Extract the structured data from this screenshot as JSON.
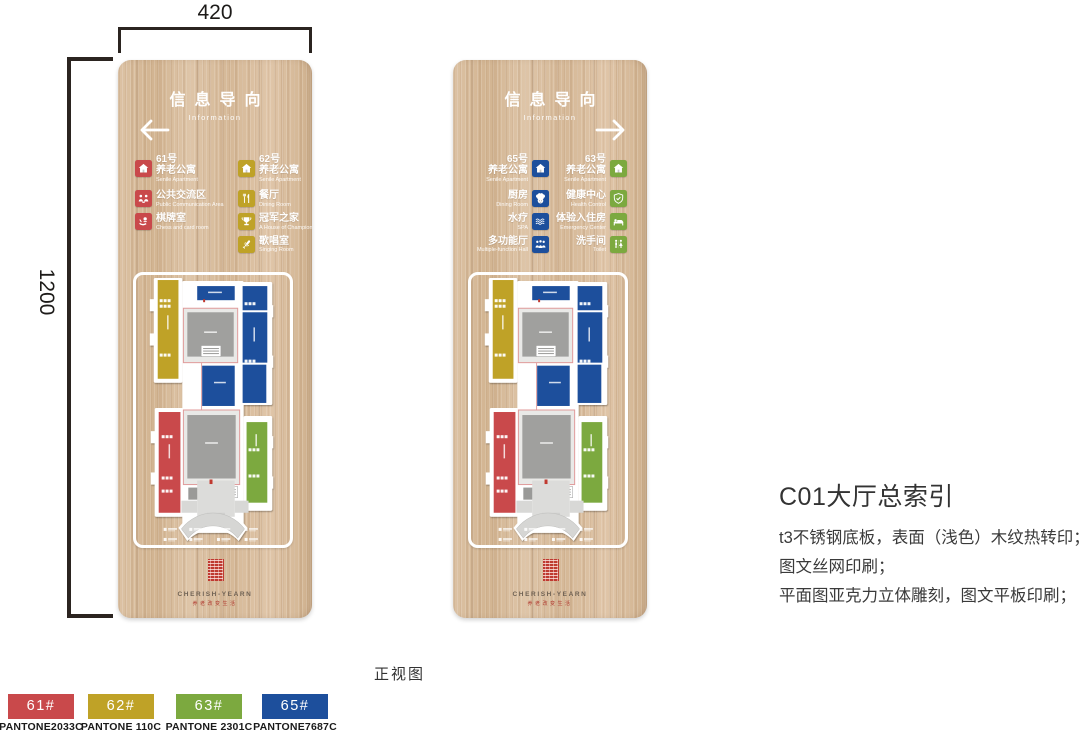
{
  "sheet": {
    "front_view_label": "正视图",
    "dim_width": "420",
    "dim_height": "1200"
  },
  "notes": {
    "title": "C01大厅总索引",
    "line1": "t3不锈钢底板，表面（浅色）木纹热转印；",
    "line2": "图文丝网印刷；",
    "line3": "平面图亚克力立体雕刻，图文平板印刷；"
  },
  "brand": {
    "name": "CHERISH-YEARN",
    "tagline": "养老改变生活"
  },
  "panels": {
    "left": {
      "header_title": "信息导向",
      "header_subtitle": "Information",
      "arrow": "left",
      "columns": [
        {
          "color": "#C9494B",
          "items": [
            {
              "icon": "house-icon",
              "no": "61号",
              "zh": "养老公寓",
              "en": "Senile Apartment"
            },
            {
              "icon": "people-icon",
              "zh": "公共交流区",
              "en": "Public Communication Area"
            },
            {
              "icon": "chess-icon",
              "zh": "棋牌室",
              "en": "Chess and card room"
            }
          ]
        },
        {
          "color": "#BFA227",
          "items": [
            {
              "icon": "house-icon",
              "no": "62号",
              "zh": "养老公寓",
              "en": "Senile Apartment"
            },
            {
              "icon": "dining-icon",
              "zh": "餐厅",
              "en": "Dining Room"
            },
            {
              "icon": "trophy-icon",
              "zh": "冠军之家",
              "en": "A House of Champions"
            },
            {
              "icon": "microphone-icon",
              "zh": "歌唱室",
              "en": "Singing Room"
            }
          ]
        }
      ]
    },
    "right": {
      "header_title": "信息导向",
      "header_subtitle": "Information",
      "arrow": "right",
      "columns": [
        {
          "color": "#1D4F9C",
          "items": [
            {
              "icon": "house-icon",
              "no": "65号",
              "zh": "养老公寓",
              "en": "Senile Apartment"
            },
            {
              "icon": "chef-icon",
              "zh": "厨房",
              "en": "Dining Room"
            },
            {
              "icon": "spa-icon",
              "zh": "水疗",
              "en": "SPA"
            },
            {
              "icon": "group-icon",
              "zh": "多功能厅",
              "en": "Multiple-function Hall"
            }
          ]
        },
        {
          "color": "#7CA93F",
          "items": [
            {
              "icon": "house-icon",
              "no": "63号",
              "zh": "养老公寓",
              "en": "Senile Apartment"
            },
            {
              "icon": "shield-icon",
              "zh": "健康中心",
              "en": "Health Control"
            },
            {
              "icon": "bed-icon",
              "zh": "体验入住房",
              "en": "Emergency Center"
            },
            {
              "icon": "toilet-icon",
              "zh": "洗手间",
              "en": "Toilet"
            }
          ]
        }
      ]
    }
  },
  "swatches": [
    {
      "label": "61#",
      "pantone": "PANTONE2033C",
      "color": "#C9494B"
    },
    {
      "label": "62#",
      "pantone": "PANTONE 110C",
      "color": "#BFA227"
    },
    {
      "label": "63#",
      "pantone": "PANTONE 2301C",
      "color": "#7CA93F"
    },
    {
      "label": "65#",
      "pantone": "PANTONE7687C",
      "color": "#1D4F9C"
    }
  ],
  "map_colors": {
    "footprint": "#FFFFFF",
    "courtyard": "#A0A09E",
    "outline_pink": "#E09A9A"
  }
}
